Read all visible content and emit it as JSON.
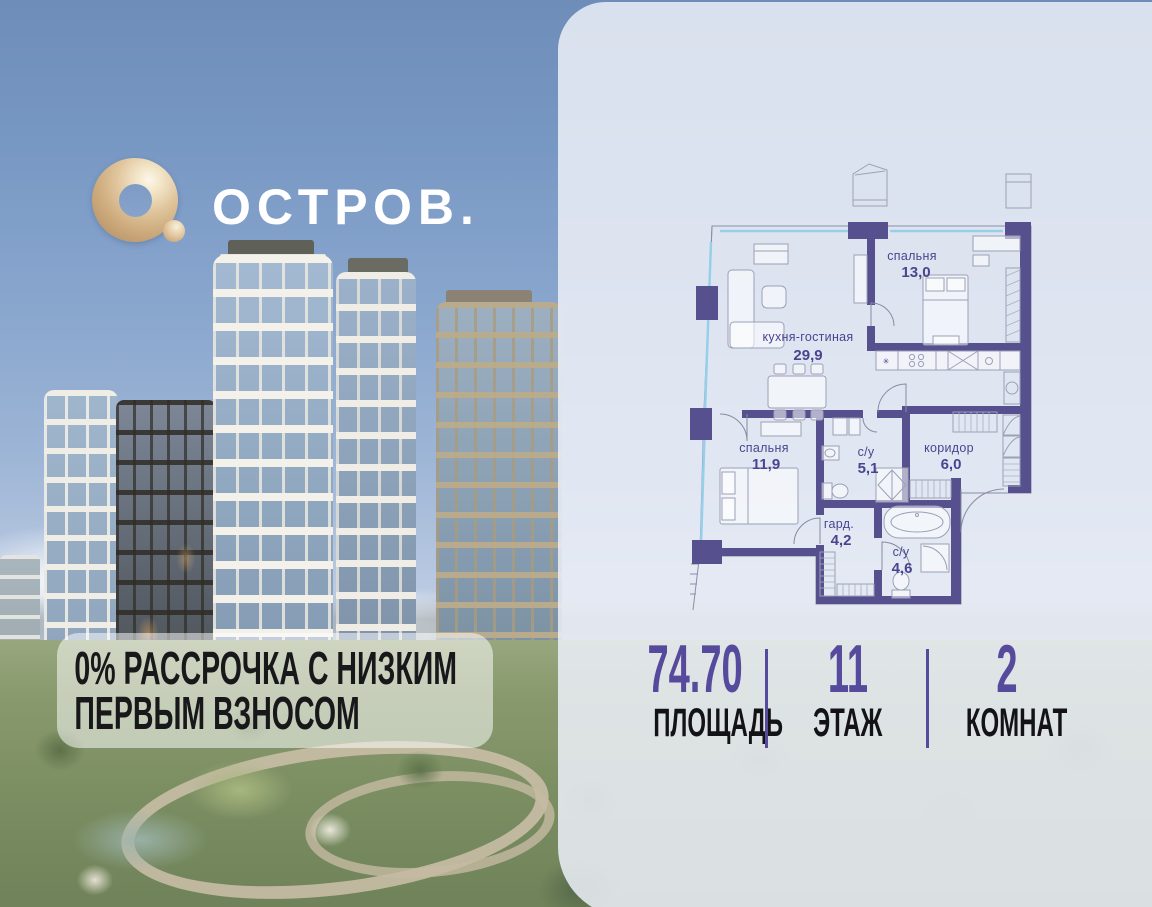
{
  "logo": {
    "brand": "ОСТРОВ.",
    "icon": "gold-torus-O",
    "gold_color": "#d9bd92"
  },
  "promo": {
    "line1": "0% РАССРОЧКА С НИЗКИМ",
    "line2": "ПЕРВЫМ ВЗНОСОМ"
  },
  "floor_plan": {
    "rooms": [
      {
        "name": "спальня",
        "area": "13,0"
      },
      {
        "name": "кухня-гостиная",
        "area": "29,9"
      },
      {
        "name": "спальня",
        "area": "11,9"
      },
      {
        "name": "с/у",
        "area": "5,1"
      },
      {
        "name": "коридор",
        "area": "6,0"
      },
      {
        "name": "гард.",
        "area": "4,2"
      },
      {
        "name": "с/у",
        "area": "4,6"
      }
    ],
    "wall_color": "#57508e",
    "label_color": "#4a4490",
    "window_color": "#97cfe9"
  },
  "stats": [
    {
      "value": "74.70",
      "label": "ПЛОЩАДЬ"
    },
    {
      "value": "11",
      "label": "ЭТАЖ"
    },
    {
      "value": "2",
      "label": "КОМНАТ"
    }
  ],
  "accent_purple": "#564a9c"
}
